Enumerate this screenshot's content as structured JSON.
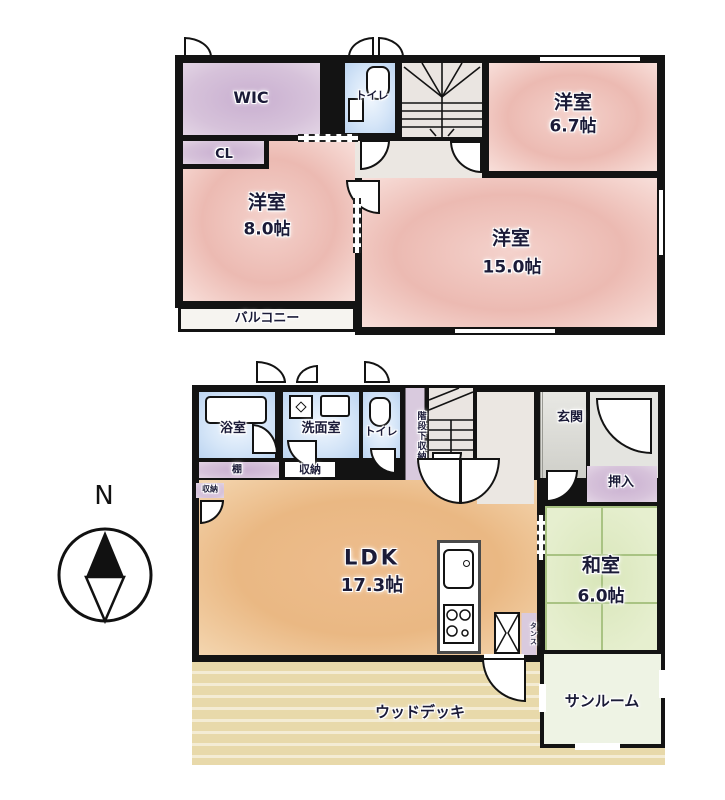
{
  "compass": {
    "north": "N"
  },
  "floor2": {
    "wic": {
      "label": "WIC"
    },
    "toilet": {
      "label": "トイレ"
    },
    "room67": {
      "name": "洋室",
      "area": "6.7帖"
    },
    "cl": {
      "label": "CL"
    },
    "room80": {
      "name": "洋室",
      "area": "8.0帖"
    },
    "room150": {
      "name": "洋室",
      "area": "15.0帖"
    },
    "balcony": {
      "label": "バルコニー"
    }
  },
  "floor1": {
    "bath": {
      "label": "浴室"
    },
    "washroom": {
      "label": "洗面室"
    },
    "toilet": {
      "label": "トイレ"
    },
    "under_stair_storage": {
      "label": "階段下収納"
    },
    "entrance": {
      "label": "玄関"
    },
    "oshiire": {
      "label": "押入"
    },
    "shelf": {
      "label": "棚"
    },
    "storage": {
      "label": "収納"
    },
    "storage_small": {
      "label": "収納"
    },
    "ldk": {
      "name": "LDK",
      "area": "17.3帖"
    },
    "japanese_room": {
      "name": "和室",
      "area": "6.0帖"
    },
    "tansu": {
      "label": "タンス"
    },
    "wood_deck": {
      "label": "ウッドデッキ"
    },
    "sunroom": {
      "label": "サンルーム"
    }
  },
  "colors": {
    "wall": "#131313",
    "western_room_pink": "#ecbab2",
    "closet_purple": "#d6c2da",
    "water_area_blue": "#d6e6f8",
    "ldk_orange": "#eab883",
    "tatami_green": "#e3ecca",
    "deck_tan": "#e8d9aa",
    "sunroom_green": "#eef3e4"
  }
}
